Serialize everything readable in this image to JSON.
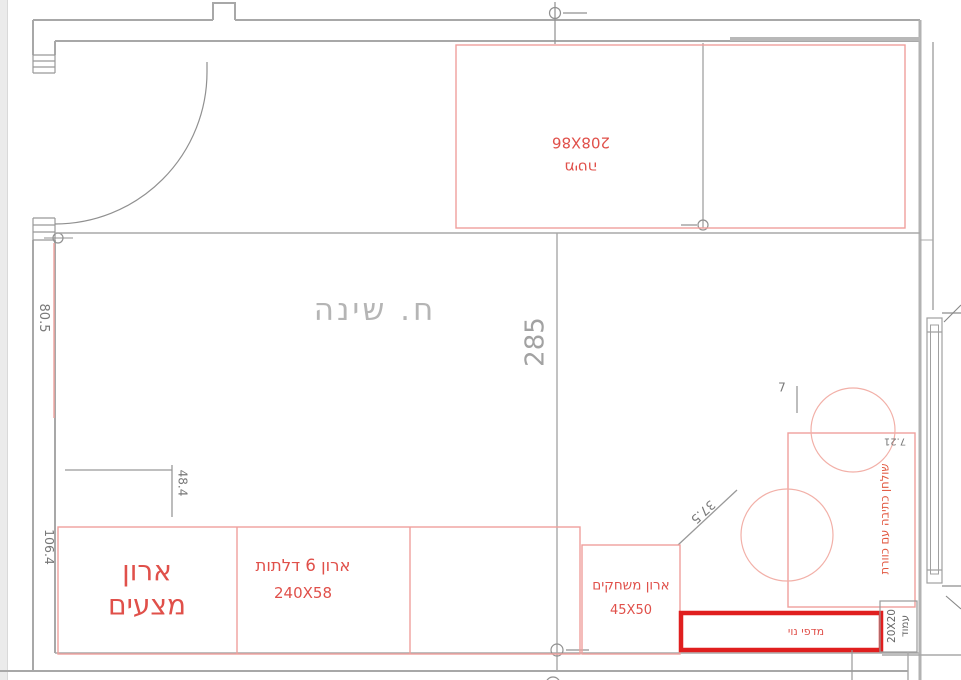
{
  "drawing": {
    "room_label": "ח. שינה",
    "bed": {
      "size": "208X86",
      "label": "מיטה"
    },
    "linen_closet": {
      "line1": "ארון",
      "line2": "מצעים"
    },
    "six_door_closet": {
      "label": "ארון 6 דלתות",
      "size": "240X58"
    },
    "games_closet": {
      "label": "ארון משחקים",
      "size": "45X50"
    },
    "decor_shelves": {
      "label": "מדפי נוי"
    },
    "column": {
      "size": "20X20",
      "label": "עמוד"
    },
    "desk": {
      "label": "שולחן כתיבה עם כוורת"
    },
    "dims": {
      "room_width": "285",
      "left_upper": "80.5",
      "left_lower": "106.4",
      "closet_offset": "48.4",
      "diagonal": "37.5",
      "desk_gap": "7.21",
      "small": "7"
    }
  },
  "colors": {
    "wall": "#a8a8a8",
    "furniture_line": "#f0a09c",
    "furniture_text": "#e0504a",
    "desk_text": "#e25840",
    "highlight_box": "#e01f1f",
    "dim_text": "#787878",
    "room_text": "#b5b5b5"
  }
}
